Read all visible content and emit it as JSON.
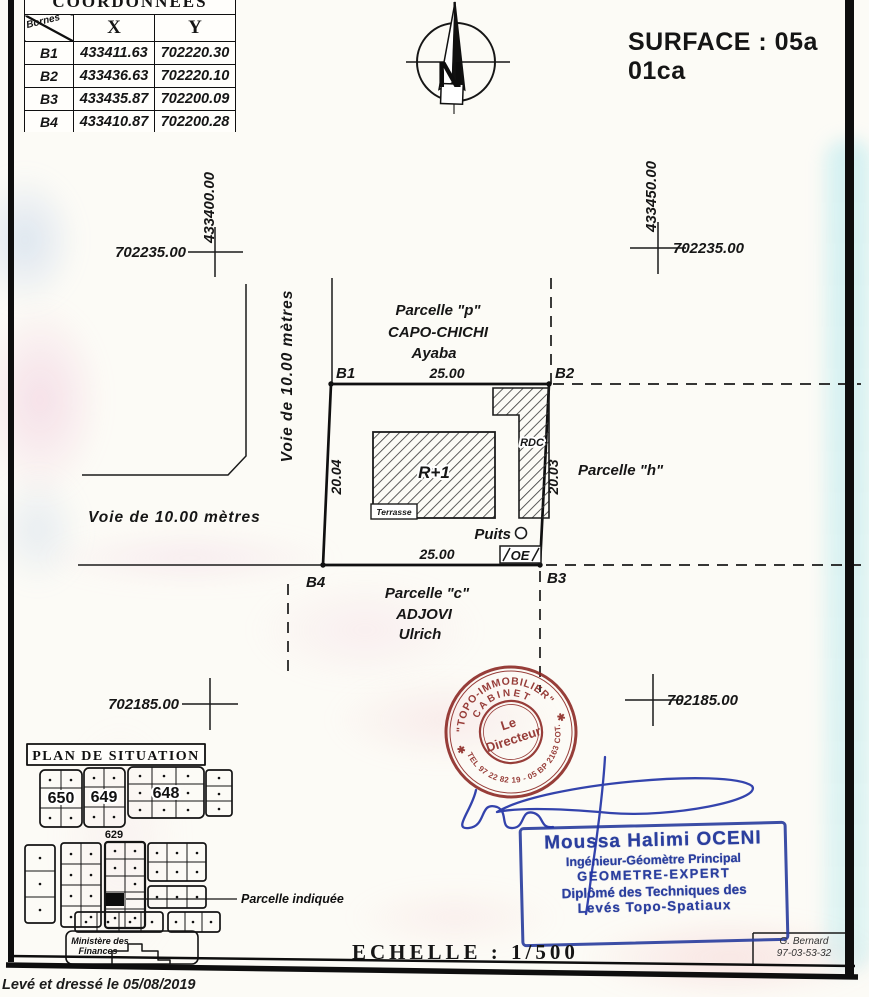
{
  "surface_label": "SURFACE : 05a 01ca",
  "coordinates_table": {
    "title": "COORDONNEES",
    "corner_label": "Bornes",
    "columns": [
      "X",
      "Y"
    ],
    "rows": [
      {
        "borne": "B1",
        "x": "433411.63",
        "y": "702220.30"
      },
      {
        "borne": "B2",
        "x": "433436.63",
        "y": "702220.10"
      },
      {
        "borne": "B3",
        "x": "433435.87",
        "y": "702200.09"
      },
      {
        "borne": "B4",
        "x": "433410.87",
        "y": "702200.28"
      }
    ]
  },
  "compass": {
    "north_letter": "N"
  },
  "grid_crosses": {
    "top_left": {
      "x_label": "433400.00",
      "y_label": "702235.00"
    },
    "top_right": {
      "x_label": "433450.00",
      "y_label": "702235.00"
    },
    "bottom_left": {
      "y_label": "702185.00"
    },
    "bottom_right": {
      "y_label": "702185.00"
    }
  },
  "parcel": {
    "bornes": [
      "B1",
      "B2",
      "B3",
      "B4"
    ],
    "dim_top": "25.00",
    "dim_bottom": "25.00",
    "dim_left": "20.04",
    "dim_right": "20.03",
    "building_main": "R+1",
    "building_annex": "RDC",
    "terrace": "Terrasse",
    "well": "Puits",
    "oe": "OE"
  },
  "neighbors": {
    "north": {
      "line1": "Parcelle \"p\"",
      "line2": "CAPO-CHICHI",
      "line3": "Ayaba"
    },
    "east": "Parcelle \"h\"",
    "south": {
      "line1": "Parcelle \"c\"",
      "line2": "ADJOVI",
      "line3": "Ulrich"
    }
  },
  "roads": {
    "west": "Voie de 10.00 mètres",
    "south": "Voie de 10.00 mètres"
  },
  "round_stamp": {
    "arc_top": "\"TOPO-IMMOBILIER\"",
    "arc_mid": "CABINET",
    "center_line1": "Le",
    "center_line2": "Directeur",
    "arc_bottom": "TEL 97 22 82 19 - 05 BP 2163 COT.",
    "star": "✱"
  },
  "blue_stamp": {
    "line1": "Moussa Halimi OCENI",
    "line2": "Ingénieur-Géomètre Principal",
    "line3": "GEOMETRE-EXPERT",
    "line4": "Diplômé des Techniques des",
    "line5": "Levés Topo-Spatiaux"
  },
  "situation_plan": {
    "title": "PLAN DE SITUATION",
    "blocks": [
      "650",
      "649",
      "648",
      "629"
    ],
    "highlight_label": "Parcelle indiquée",
    "ministry_line1": "Ministère des",
    "ministry_line2": "Finances"
  },
  "scale_label": "ECHELLE : 1/500",
  "surveyor": {
    "name": "G. Bernard",
    "phone": "97-03-53-32"
  },
  "footer_note": "Levé et dressé le 05/08/2019",
  "colors": {
    "ink": "#1a1a1a",
    "stamp_red": "#8a2420",
    "stamp_blue": "#2b3f9e"
  }
}
